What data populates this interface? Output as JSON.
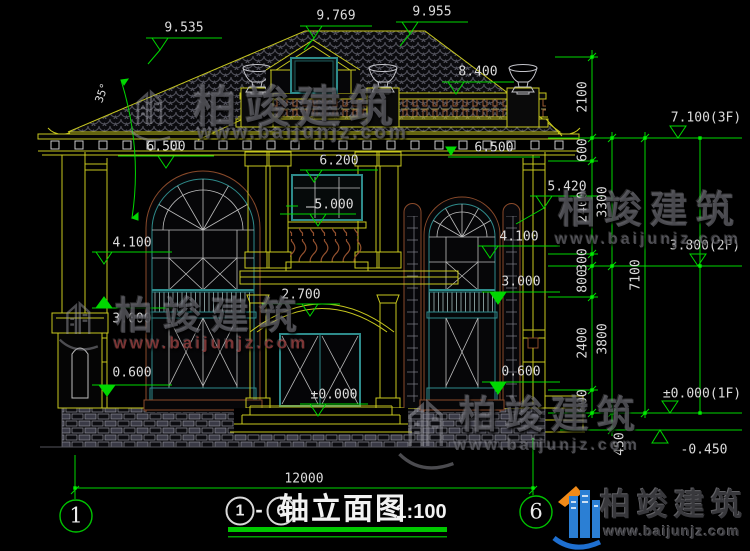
{
  "page": {
    "background": "#000000"
  },
  "colors": {
    "dimension_green": "#00d800",
    "line_yellow": "#c8c81e",
    "frame_teal": "#2e8b8b",
    "accent_brown": "#8a4a2a",
    "text_white": "#dcdcdc",
    "logo_blue": "#2b7fd4",
    "logo_orange": "#f08a18"
  },
  "levels": {
    "top": [
      "9.535",
      "9.769",
      "9.955",
      "8.400"
    ],
    "left_wall": [
      "6.500",
      "4.100",
      "3.000",
      "0.600"
    ],
    "center": [
      "6.200",
      "5.000",
      "2.700",
      "±0.000"
    ],
    "right_wall": [
      "6.500",
      "5.420",
      "4.100",
      "3.000",
      "0.600"
    ],
    "floors": [
      "7.100(3F)",
      "3.800(2F)",
      "±0.000(1F)",
      "-0.450"
    ]
  },
  "dim_chains": {
    "inner": [
      "2100",
      "600",
      "2400",
      "300",
      "800",
      "2400",
      "600"
    ],
    "middle": [
      "3300",
      "3800",
      "450"
    ],
    "outer": "7100",
    "overall_width": "12000"
  },
  "roof": {
    "slope_angle": "35°"
  },
  "axis_bubbles": {
    "left": "1",
    "right": "6"
  },
  "title_block": {
    "axis_start": "1",
    "separator": "-",
    "axis_end": "6",
    "label": "轴立面图",
    "scale": "1:100"
  },
  "watermark": {
    "brand": "柏竣建筑",
    "url": "www.baijunjz.com"
  },
  "logo": {
    "brand": "柏竣建筑",
    "url": "www.baijunjz.com"
  }
}
